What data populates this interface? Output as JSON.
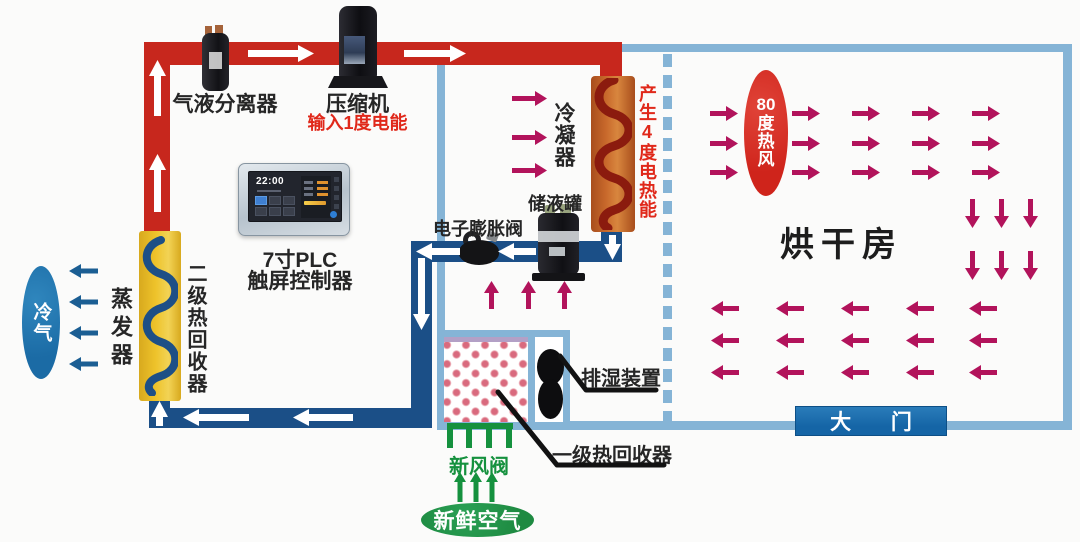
{
  "colors": {
    "pipe_hot": "#c7271d",
    "pipe_cold": "#1b4f87",
    "wall": "#85b4d6",
    "crimson": "#b2135b",
    "green": "#15913e",
    "fresh_green": "#1e8a41",
    "orange_box": "#c96a2c",
    "coil_hot": "#8b1b0e",
    "coil_cold": "#1d4f86",
    "yellow_box": "#eec32b",
    "gate_blue": "#1565a6",
    "cold_ellipse": "#1b6ba5",
    "hot_ellipse": "#cf241b",
    "red_text": "#e0281a"
  },
  "components": {
    "gas_liquid_separator": {
      "label": "气液分离器"
    },
    "compressor": {
      "label": "压缩机",
      "input_label": "输入1度电能"
    },
    "plc": {
      "label_line1": "7寸PLC",
      "label_line2": "触屏控制器",
      "time": "22:00"
    },
    "evaporator": {
      "label": "蒸发器"
    },
    "secondary_heat_recovery": {
      "label": "二级热回收器"
    },
    "cold_air": {
      "label": "冷气"
    },
    "condenser": {
      "label": "冷凝器"
    },
    "heat_output": {
      "label": "产生4度电热能"
    },
    "storage_tank": {
      "label": "储液罐"
    },
    "expansion_valve": {
      "label": "电子膨胀阀"
    },
    "dehumidifier": {
      "label": "排湿装置"
    },
    "primary_heat_recovery": {
      "label": "一级热回收器"
    },
    "fresh_air_valve": {
      "label": "新风阀"
    },
    "fresh_air": {
      "label": "新鲜空气"
    },
    "drying_room": {
      "label": "烘干房"
    },
    "hot_air": {
      "chars": [
        "80",
        "度",
        "热",
        "风"
      ]
    },
    "gate": {
      "label": "大 门"
    }
  },
  "flows": {
    "refrigerant_white": {
      "color": "#ffffff",
      "style": {
        "head": 16,
        "width": 17,
        "shaft": 7
      },
      "arrows": [
        {
          "dir": "right",
          "x": 248,
          "y": 45,
          "len": 66
        },
        {
          "dir": "right",
          "x": 404,
          "y": 45,
          "len": 62
        },
        {
          "dir": "up",
          "x": 149,
          "y": 60,
          "len": 56
        },
        {
          "dir": "up",
          "x": 149,
          "y": 154,
          "len": 58
        },
        {
          "dir": "down",
          "x": 604,
          "y": 235,
          "len": 25
        },
        {
          "dir": "left",
          "x": 416,
          "y": 243,
          "len": 44
        },
        {
          "dir": "left",
          "x": 498,
          "y": 243,
          "len": 38
        },
        {
          "dir": "down",
          "x": 413,
          "y": 258,
          "len": 72
        },
        {
          "dir": "left",
          "x": 183,
          "y": 409,
          "len": 66
        },
        {
          "dir": "left",
          "x": 293,
          "y": 409,
          "len": 60
        },
        {
          "dir": "up",
          "x": 151,
          "y": 401,
          "len": 25
        }
      ]
    },
    "condenser_hot_air": {
      "color": "#b2135b",
      "style": {
        "head": 12,
        "width": 15,
        "shaft": 5
      },
      "arrows": [
        {
          "dir": "right",
          "x": 512,
          "y": 91,
          "len": 35
        },
        {
          "dir": "right",
          "x": 512,
          "y": 130,
          "len": 35
        },
        {
          "dir": "right",
          "x": 512,
          "y": 163,
          "len": 35
        }
      ]
    },
    "recovered_air_up": {
      "color": "#b2135b",
      "style": {
        "head": 12,
        "width": 15,
        "shaft": 5
      },
      "arrows": [
        {
          "dir": "up",
          "x": 484,
          "y": 281,
          "len": 28
        },
        {
          "dir": "up",
          "x": 521,
          "y": 281,
          "len": 28
        },
        {
          "dir": "up",
          "x": 557,
          "y": 281,
          "len": 28
        }
      ]
    },
    "room_air_right": {
      "color": "#b2135b",
      "style": {
        "head": 12,
        "width": 15,
        "shaft": 5
      },
      "arrows": [
        {
          "dir": "right",
          "x": 710,
          "y": 106,
          "len": 28
        },
        {
          "dir": "right",
          "x": 792,
          "y": 106,
          "len": 28
        },
        {
          "dir": "right",
          "x": 852,
          "y": 106,
          "len": 28
        },
        {
          "dir": "right",
          "x": 912,
          "y": 106,
          "len": 28
        },
        {
          "dir": "right",
          "x": 972,
          "y": 106,
          "len": 28
        },
        {
          "dir": "right",
          "x": 710,
          "y": 136,
          "len": 28
        },
        {
          "dir": "right",
          "x": 792,
          "y": 136,
          "len": 28
        },
        {
          "dir": "right",
          "x": 852,
          "y": 136,
          "len": 28
        },
        {
          "dir": "right",
          "x": 912,
          "y": 136,
          "len": 28
        },
        {
          "dir": "right",
          "x": 972,
          "y": 136,
          "len": 28
        },
        {
          "dir": "right",
          "x": 710,
          "y": 165,
          "len": 28
        },
        {
          "dir": "right",
          "x": 792,
          "y": 165,
          "len": 28
        },
        {
          "dir": "right",
          "x": 852,
          "y": 165,
          "len": 28
        },
        {
          "dir": "right",
          "x": 912,
          "y": 165,
          "len": 28
        },
        {
          "dir": "right",
          "x": 972,
          "y": 165,
          "len": 28
        }
      ]
    },
    "room_air_down": {
      "color": "#b2135b",
      "style": {
        "head": 12,
        "width": 15,
        "shaft": 5
      },
      "arrows": [
        {
          "dir": "down",
          "x": 965,
          "y": 199,
          "len": 29
        },
        {
          "dir": "down",
          "x": 994,
          "y": 199,
          "len": 29
        },
        {
          "dir": "down",
          "x": 1023,
          "y": 199,
          "len": 29
        },
        {
          "dir": "down",
          "x": 965,
          "y": 251,
          "len": 29
        },
        {
          "dir": "down",
          "x": 994,
          "y": 251,
          "len": 29
        },
        {
          "dir": "down",
          "x": 1023,
          "y": 251,
          "len": 29
        }
      ]
    },
    "room_air_left": {
      "color": "#b2135b",
      "style": {
        "head": 12,
        "width": 15,
        "shaft": 5
      },
      "arrows": [
        {
          "dir": "left",
          "x": 711,
          "y": 301,
          "len": 28
        },
        {
          "dir": "left",
          "x": 776,
          "y": 301,
          "len": 28
        },
        {
          "dir": "left",
          "x": 841,
          "y": 301,
          "len": 28
        },
        {
          "dir": "left",
          "x": 906,
          "y": 301,
          "len": 28
        },
        {
          "dir": "left",
          "x": 969,
          "y": 301,
          "len": 28
        },
        {
          "dir": "left",
          "x": 711,
          "y": 333,
          "len": 28
        },
        {
          "dir": "left",
          "x": 776,
          "y": 333,
          "len": 28
        },
        {
          "dir": "left",
          "x": 841,
          "y": 333,
          "len": 28
        },
        {
          "dir": "left",
          "x": 906,
          "y": 333,
          "len": 28
        },
        {
          "dir": "left",
          "x": 969,
          "y": 333,
          "len": 28
        },
        {
          "dir": "left",
          "x": 711,
          "y": 365,
          "len": 28
        },
        {
          "dir": "left",
          "x": 776,
          "y": 365,
          "len": 28
        },
        {
          "dir": "left",
          "x": 841,
          "y": 365,
          "len": 28
        },
        {
          "dir": "left",
          "x": 906,
          "y": 365,
          "len": 28
        },
        {
          "dir": "left",
          "x": 969,
          "y": 365,
          "len": 28
        }
      ]
    },
    "cold_air_out": {
      "color": "#1b5e93",
      "style": {
        "head": 12,
        "width": 14,
        "shaft": 5
      },
      "arrows": [
        {
          "dir": "left",
          "x": 69,
          "y": 264,
          "len": 29
        },
        {
          "dir": "left",
          "x": 69,
          "y": 295,
          "len": 29
        },
        {
          "dir": "left",
          "x": 69,
          "y": 326,
          "len": 29
        },
        {
          "dir": "left",
          "x": 69,
          "y": 357,
          "len": 29
        }
      ]
    },
    "fresh_air_in": {
      "color": "#15913e",
      "style": {
        "head": 10,
        "width": 12,
        "shaft": 5
      },
      "arrows": [
        {
          "dir": "up",
          "x": 454,
          "y": 472,
          "len": 30
        },
        {
          "dir": "up",
          "x": 470,
          "y": 472,
          "len": 30
        },
        {
          "dir": "up",
          "x": 486,
          "y": 472,
          "len": 30
        }
      ]
    }
  }
}
